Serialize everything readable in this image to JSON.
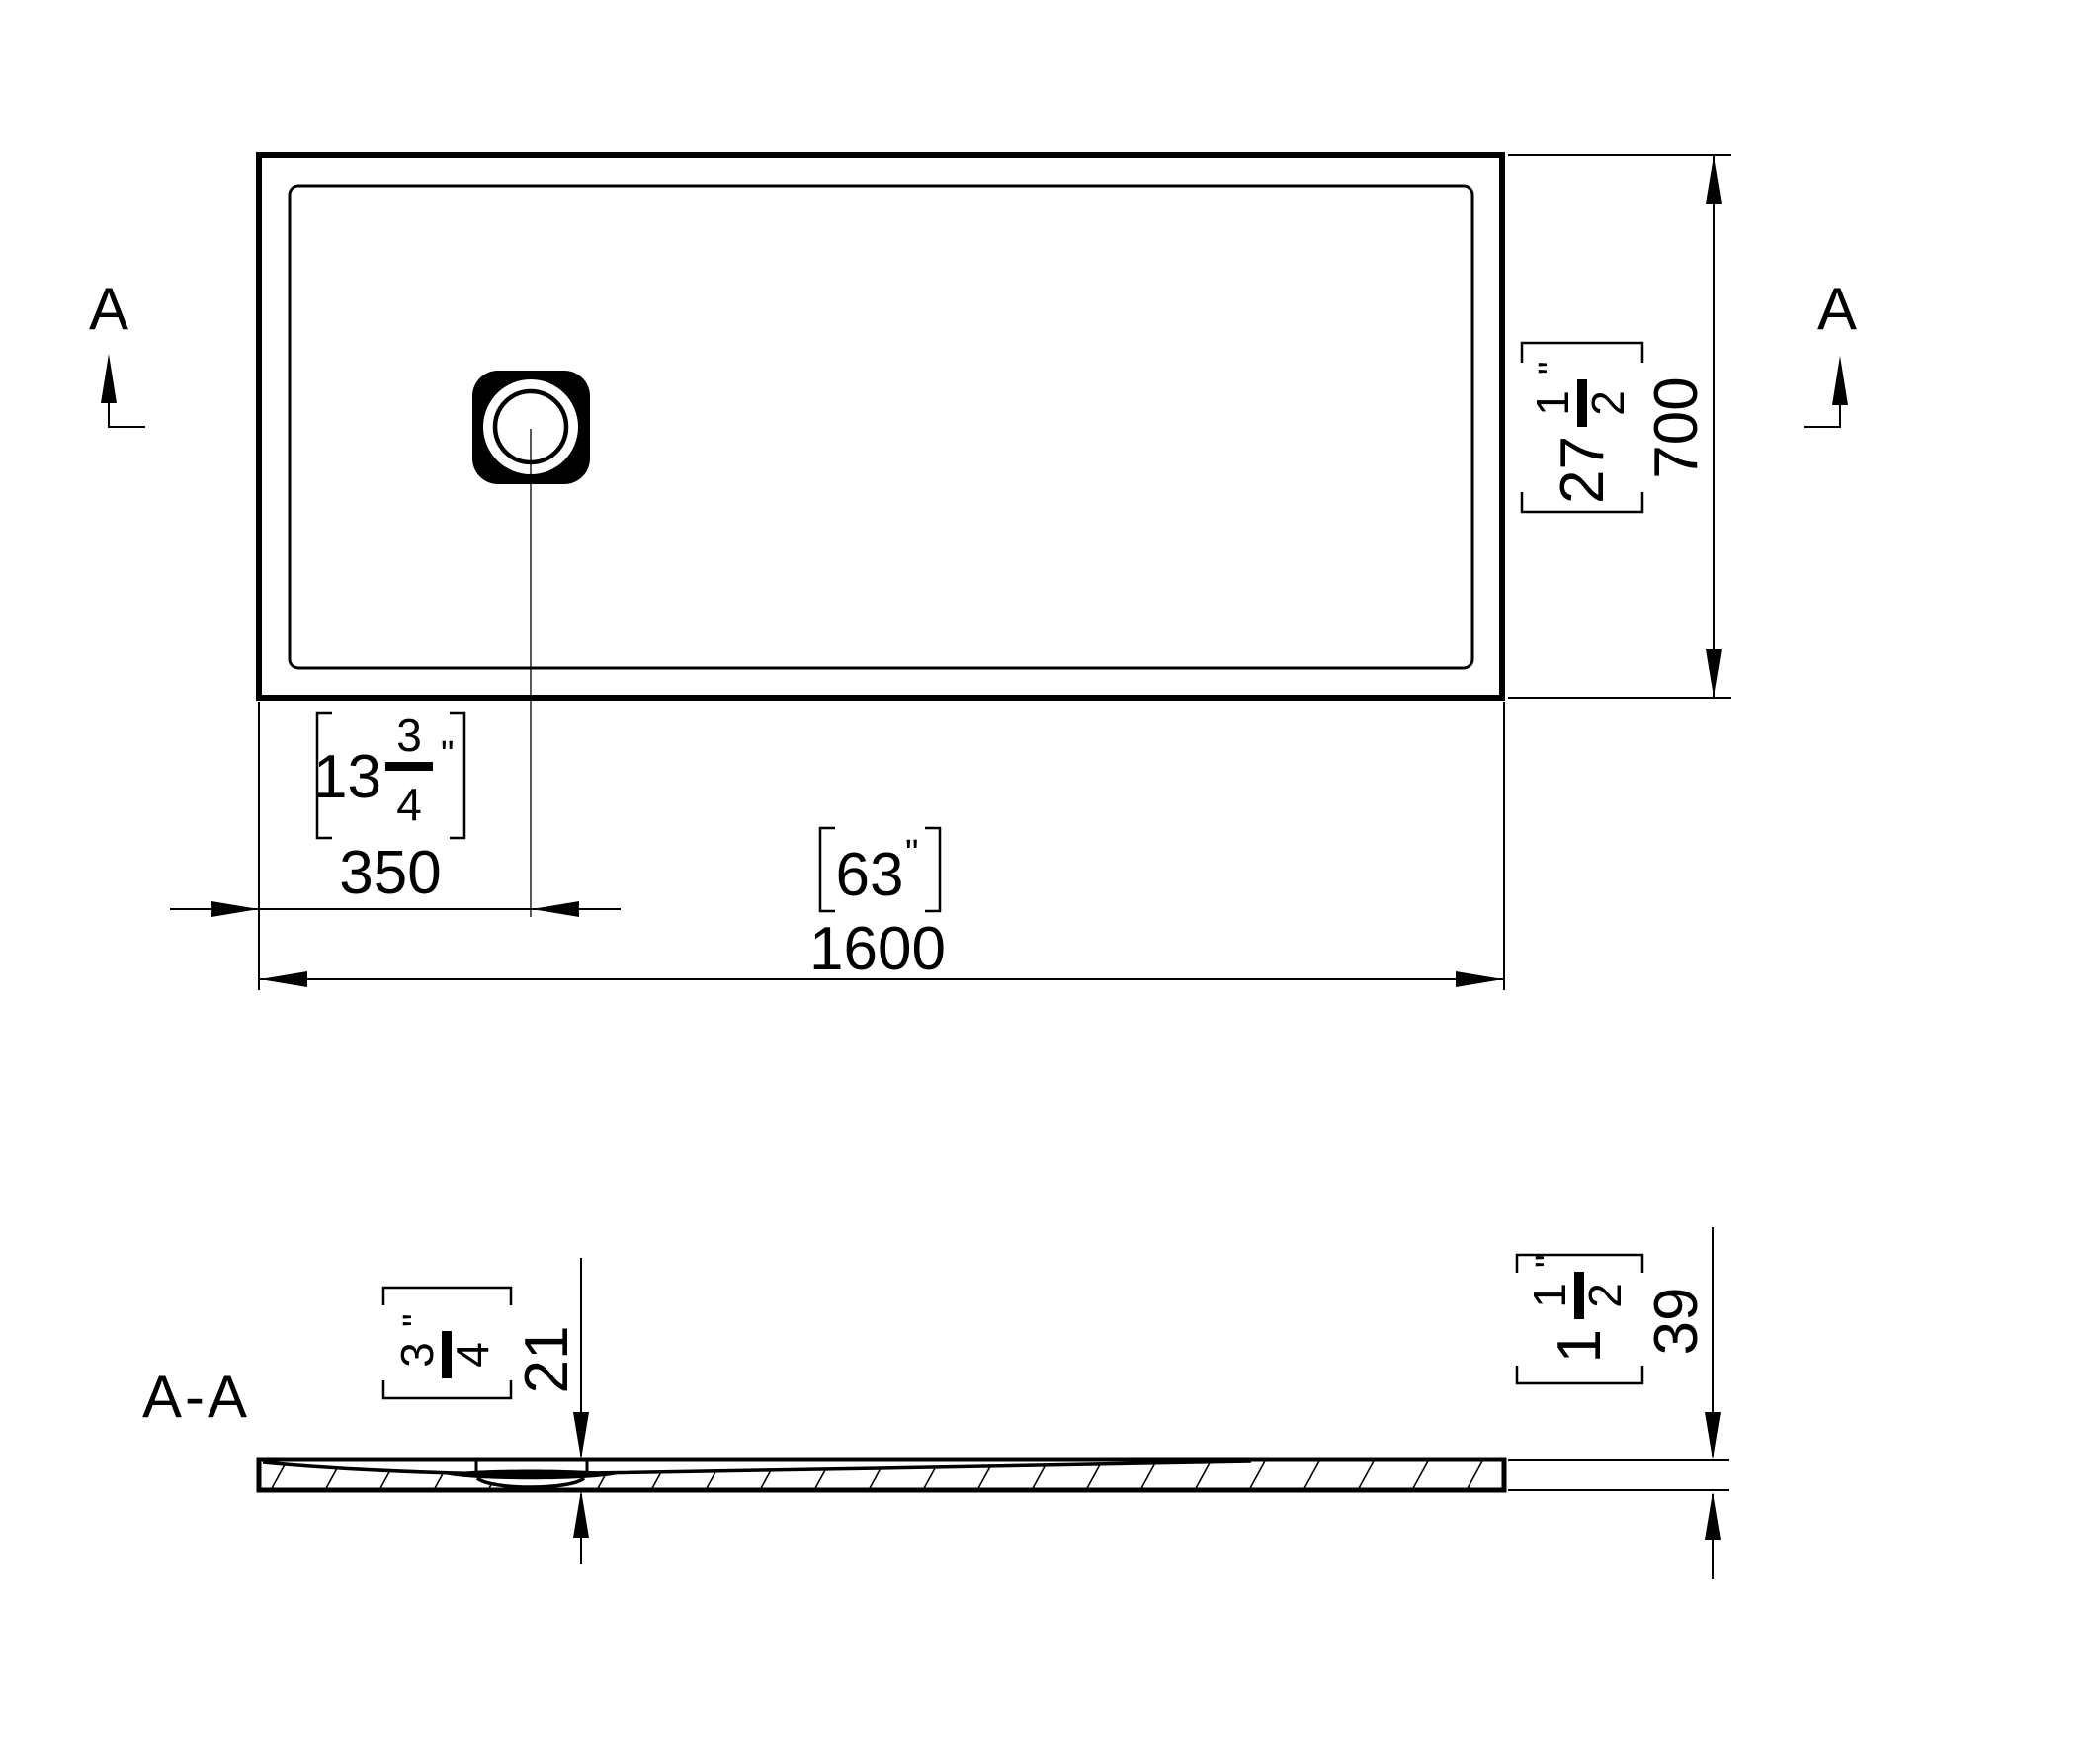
{
  "drawing": {
    "colors": {
      "line": "#000000",
      "background": "#ffffff"
    },
    "section_label": "A-A",
    "cut_marker": "A",
    "top_view": {
      "width": {
        "metric": "1600",
        "imperial_whole": "63",
        "inch_mark": "\""
      },
      "drain_offset": {
        "metric": "350",
        "imperial_whole": "13",
        "imperial_num": "3",
        "imperial_den": "4",
        "inch_mark": "\""
      },
      "depth": {
        "metric": "700",
        "imperial_whole": "27",
        "imperial_num": "1",
        "imperial_den": "2",
        "inch_mark": "\""
      }
    },
    "section_view": {
      "drain_thickness": {
        "metric": "21",
        "imperial_num": "3",
        "imperial_den": "4",
        "inch_mark": "\""
      },
      "edge_thickness": {
        "metric": "39",
        "imperial_whole": "1",
        "imperial_num": "1",
        "imperial_den": "2",
        "inch_mark": "\""
      }
    }
  }
}
